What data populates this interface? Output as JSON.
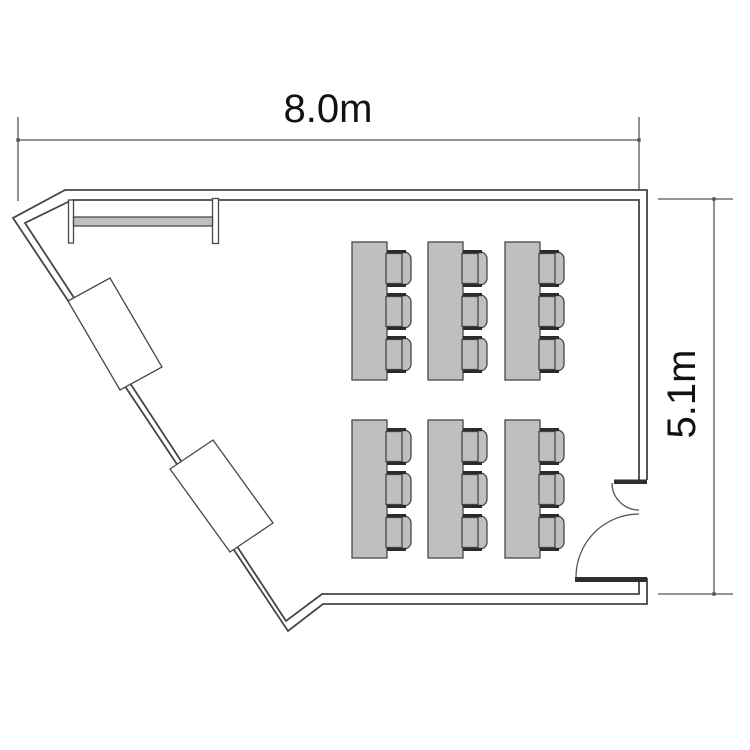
{
  "diagram": {
    "type": "floor-plan",
    "description": "Room floor plan with classroom tables, chairs, wall bench, angled wall desks and an entrance door"
  },
  "dimensions": {
    "width_label": "8.0m",
    "height_label": "5.1m"
  },
  "colors": {
    "background": "#ffffff",
    "wall_stroke": "#454545",
    "dim_stroke": "#555555",
    "text": "#111111",
    "furniture_fill": "#bfbfbf",
    "furniture_stroke": "#474747",
    "armrest_fill": "#2b2b2b",
    "door_stub_fill": "#2e2e2e"
  },
  "furniture": {
    "table_count": 6,
    "chairs_per_table": 3,
    "tables": {
      "columns_x": [
        352,
        428,
        505
      ],
      "rows_y": [
        242,
        420
      ],
      "width": 35,
      "height": 138,
      "chair_offsets_y": [
        8,
        51,
        94
      ],
      "chair_width": 25,
      "chair_height": 37
    }
  }
}
